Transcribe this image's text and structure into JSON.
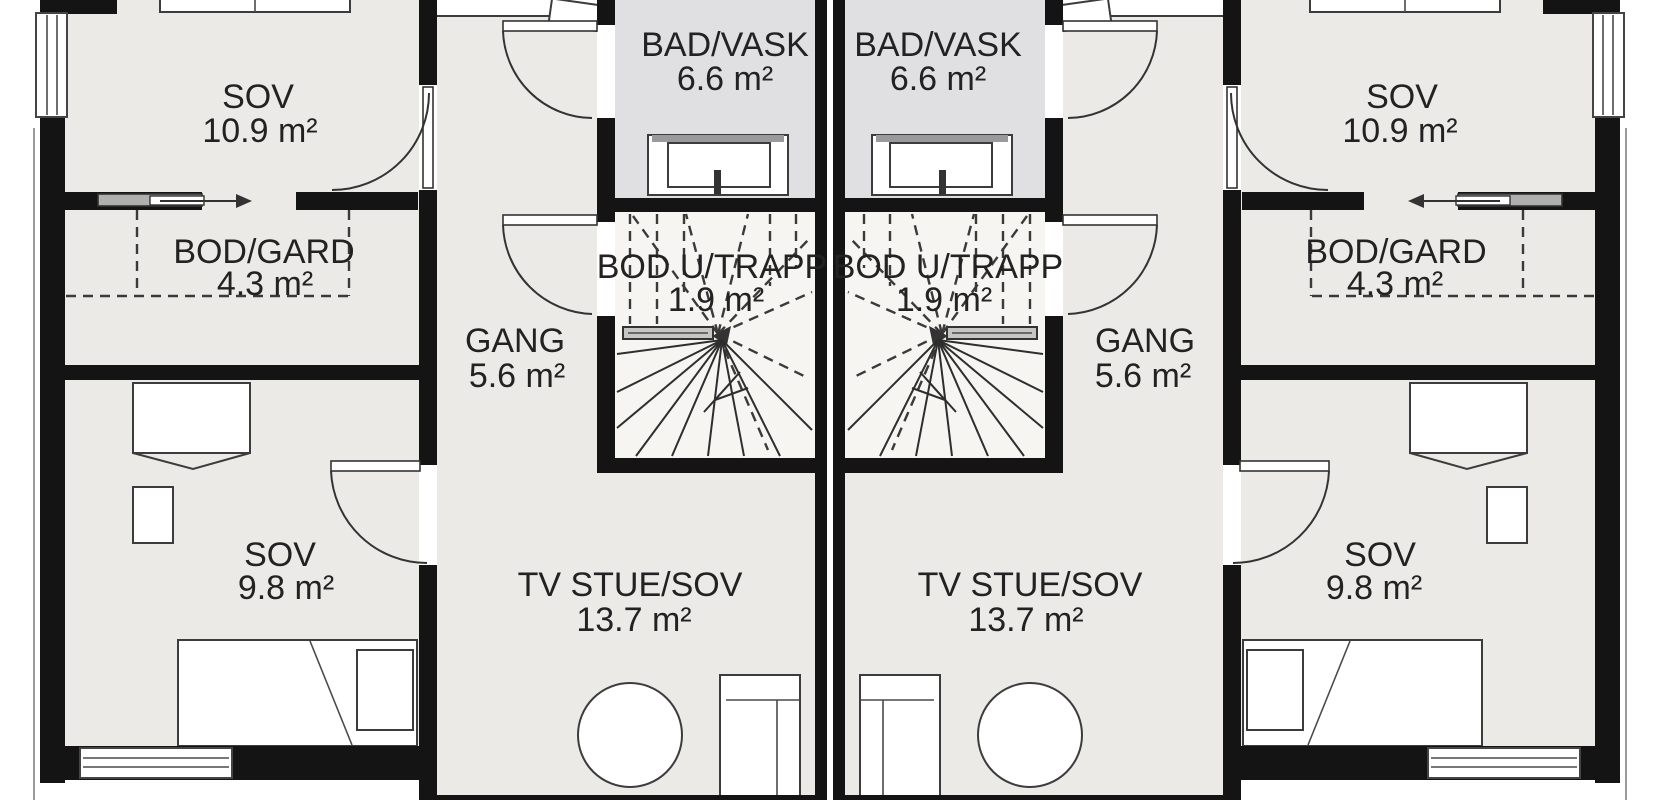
{
  "rooms": [
    {
      "name": "SOV",
      "area": "10.9 m²"
    },
    {
      "name": "BOD/GARD",
      "area": "4.3 m²"
    },
    {
      "name": "BAD/VASK",
      "area": "6.6 m²"
    },
    {
      "name": "BOD U/TRAPP",
      "area": "1.9 m²"
    },
    {
      "name": "GANG",
      "area": "5.6 m²"
    },
    {
      "name": "SOV",
      "area": "9.8 m²"
    },
    {
      "name": "TV STUE/SOV",
      "area": "13.7 m²"
    }
  ],
  "colors": {
    "wall": "#141414",
    "floor": "#ebeae6",
    "bathroom": "#e0e0e2",
    "stair": "#f6f5f2",
    "background": "#ffffff",
    "furniture_outline": "#3c3c3c",
    "sliding_panel": "#b0b0ae"
  }
}
